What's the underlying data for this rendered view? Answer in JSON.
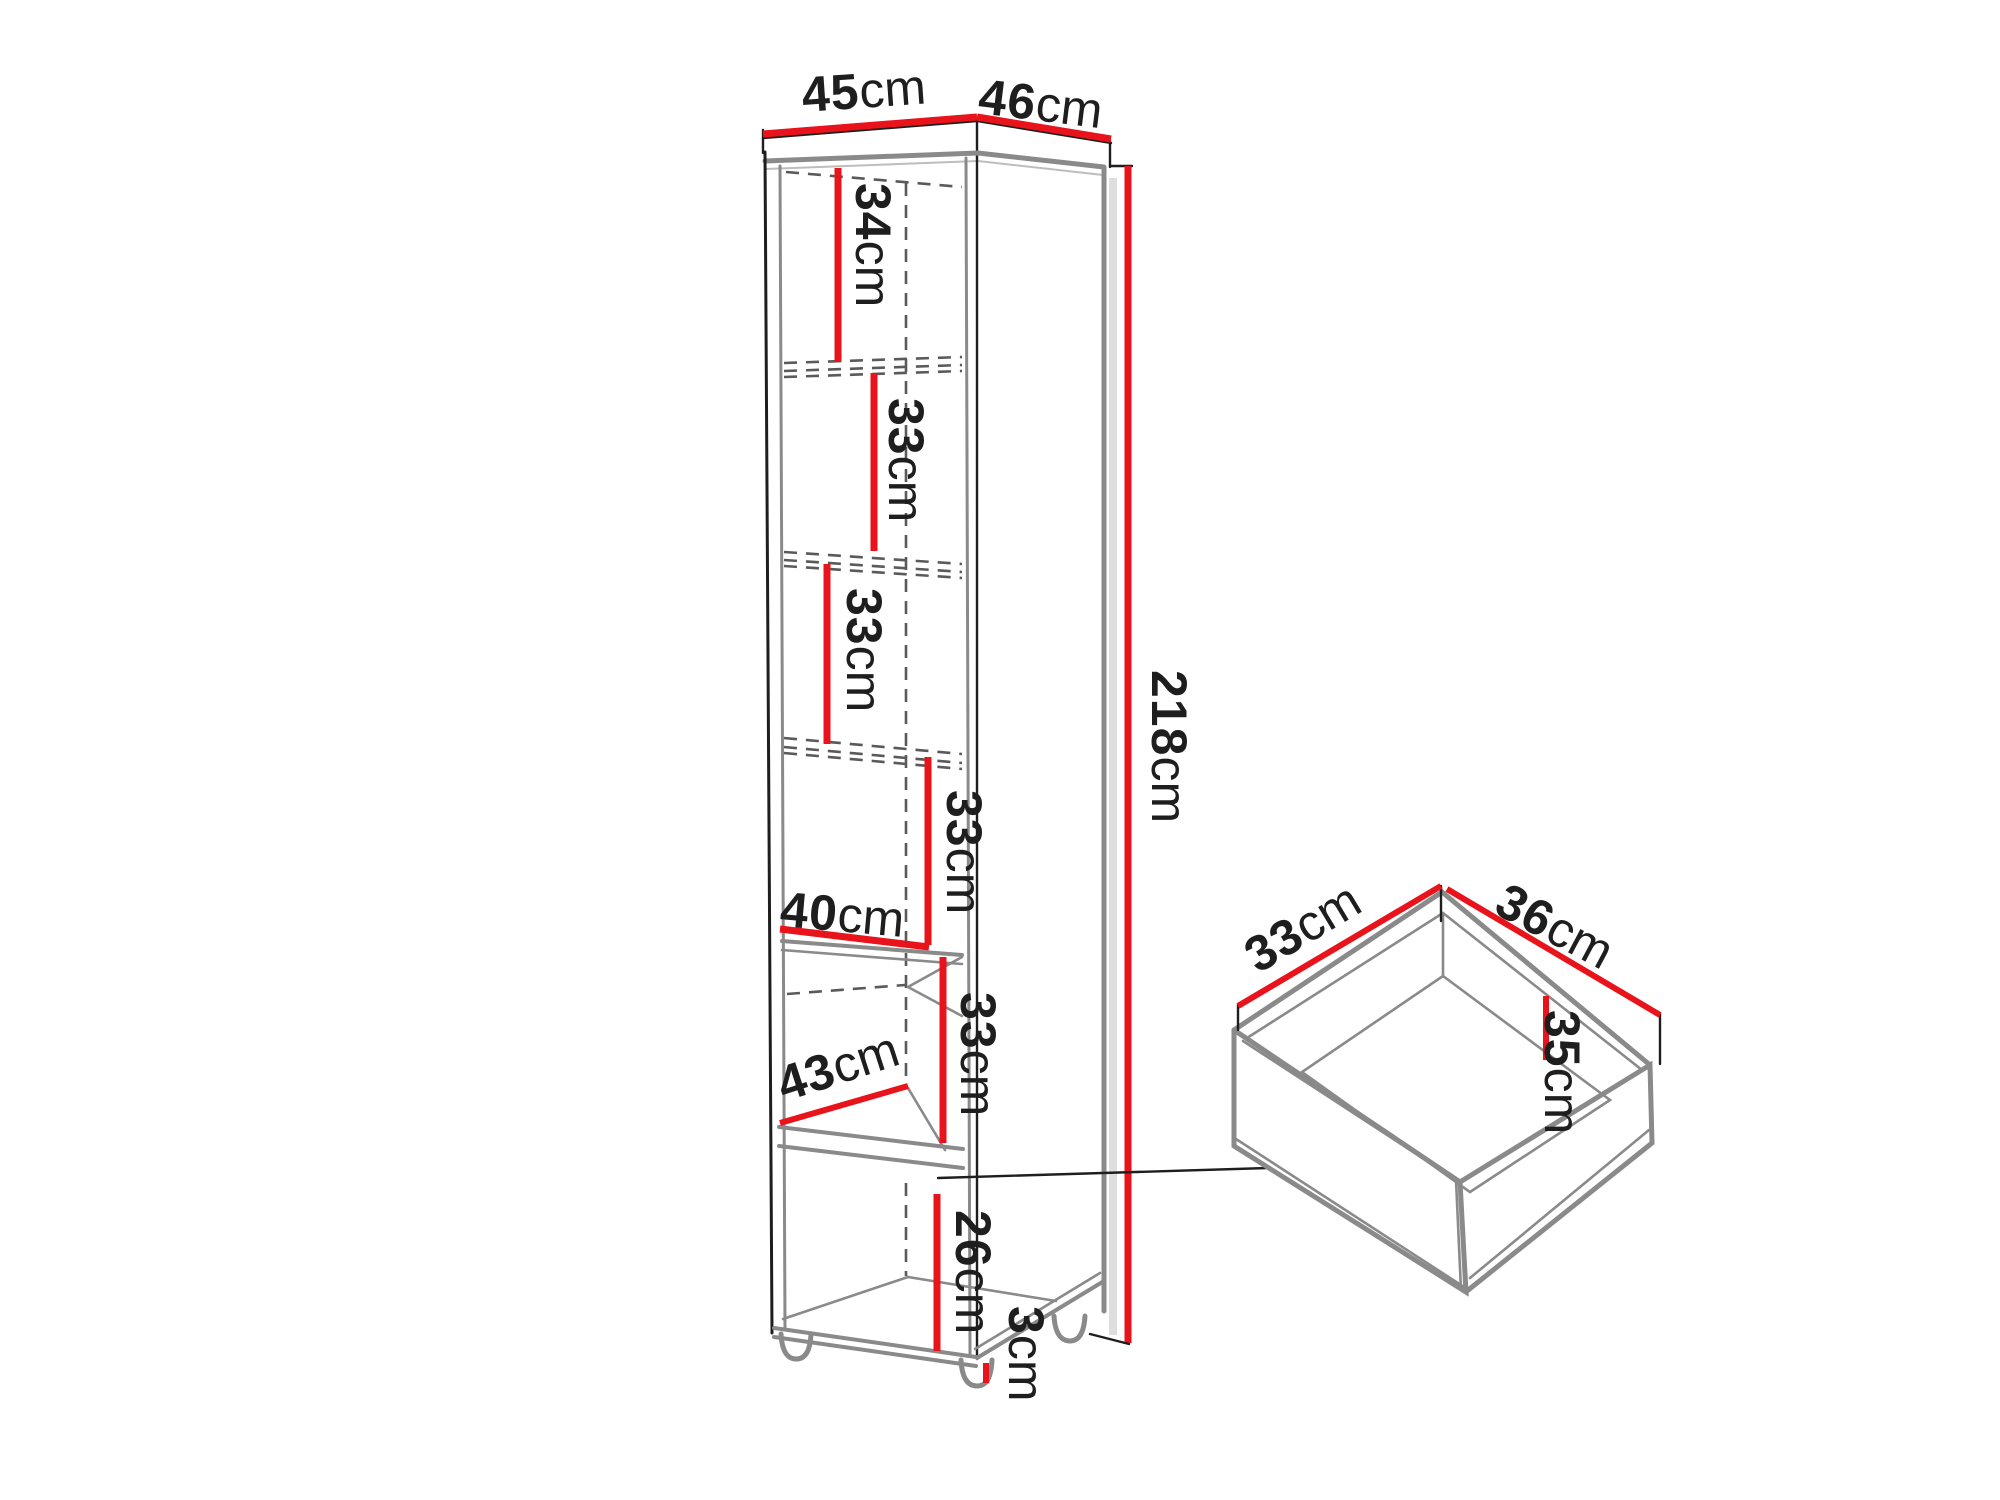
{
  "figure": {
    "type": "furniture-dimension-diagram",
    "unit": "cm"
  },
  "colors": {
    "dimension-red": "#e8131b",
    "outline-dark": "#1e1e1e",
    "panel-gray": "#8a8a8a",
    "hidden-gray": "#5a5a5a",
    "shadow-gray": "#dedede",
    "background": "#ffffff"
  },
  "cabinet": {
    "top_width": {
      "value": "45",
      "unit": "cm"
    },
    "top_depth": {
      "value": "46",
      "unit": "cm"
    },
    "height": {
      "value": "218",
      "unit": "cm"
    },
    "sections": [
      {
        "value": "34",
        "unit": "cm"
      },
      {
        "value": "33",
        "unit": "cm"
      },
      {
        "value": "33",
        "unit": "cm"
      },
      {
        "value": "33",
        "unit": "cm"
      },
      {
        "value": "33",
        "unit": "cm"
      }
    ],
    "shelf_width": {
      "value": "40",
      "unit": "cm"
    },
    "shelf_depth": {
      "value": "43",
      "unit": "cm"
    },
    "bottom_section_height": {
      "value": "26",
      "unit": "cm"
    },
    "foot_height": {
      "value": "3",
      "unit": "cm"
    }
  },
  "drawer": {
    "inner_depth": {
      "value": "33",
      "unit": "cm"
    },
    "inner_width": {
      "value": "36",
      "unit": "cm"
    },
    "inner_height": {
      "value": "35",
      "unit": "cm"
    }
  }
}
